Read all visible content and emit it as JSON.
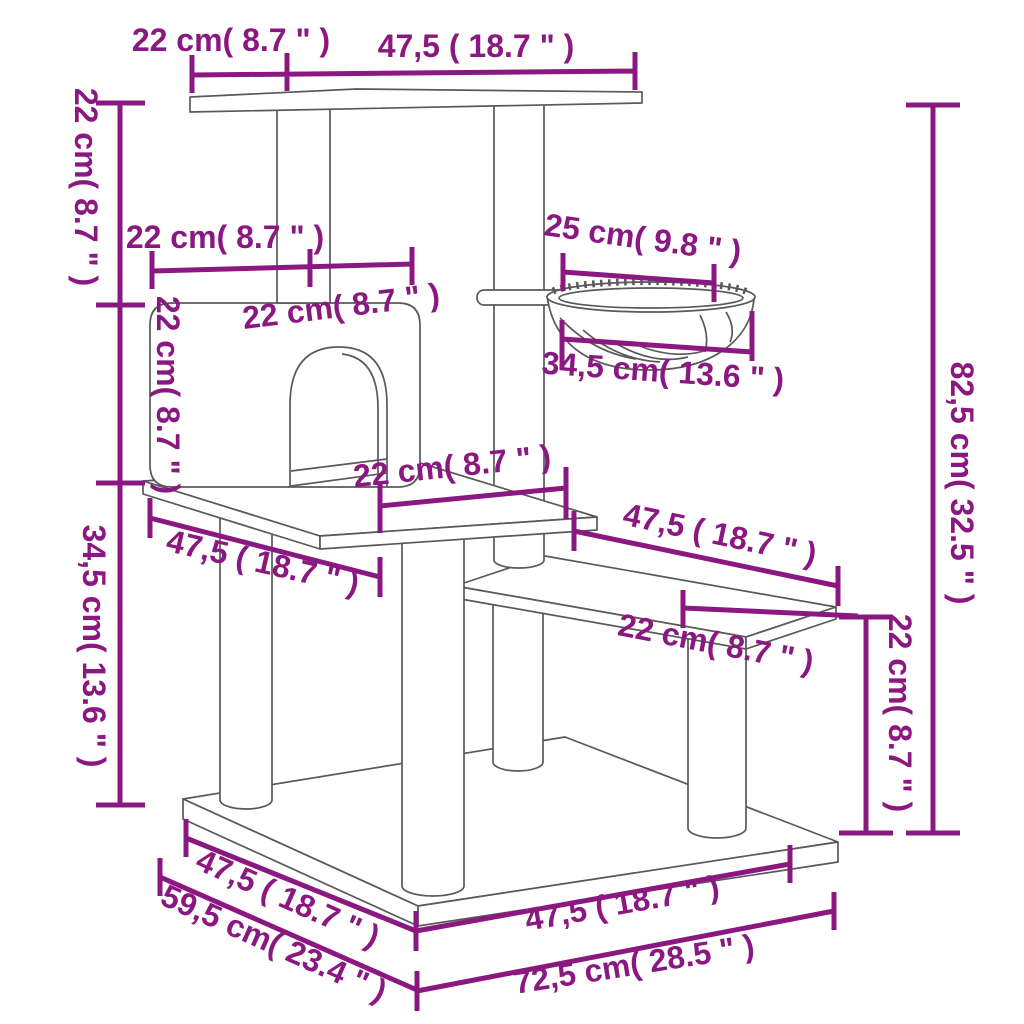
{
  "diagram": {
    "kind": "product-dimension-diagram",
    "subject": "cat tree with scratching posts, condo house, hammock basket, step platform and base",
    "unit_style": "centimeters with inches in parentheses"
  },
  "colors": {
    "dimension_accent": "#8b1880",
    "line_art": "#595959",
    "background": "#ffffff"
  },
  "dimensions": {
    "top_offset": "22 cm( 8.7 \" )",
    "top_platform_length": "47,5 ( 18.7 \" )",
    "upper_section_height": "22 cm( 8.7 \" )",
    "house_width": "22 cm( 8.7 \" )",
    "house_post_spacing": "22 cm( 8.7 \" )",
    "house_height": "22 cm( 8.7 \" )",
    "hammock_opening": "25 cm( 9.8 \" )",
    "hammock_width": "34,5 cm( 13.6 \" )",
    "mid_platform_depth": "22 cm( 8.7 \" )",
    "mid_platform_length": "47,5 ( 18.7 \" )",
    "step_platform_length": "47,5 ( 18.7 \" )",
    "step_platform_depth": "22 cm( 8.7 \" )",
    "total_height": "82,5 cm( 32.5 \" )",
    "step_height": "22 cm( 8.7 \" )",
    "lower_section_height": "34,5 cm( 13.6 \" )",
    "base_length_left": "47,5 ( 18.7 \" )",
    "base_depth_left": "59,5 cm( 23.4 \" )",
    "base_length_right": "47,5 ( 18.7 \" )",
    "base_width_right": "72,5 cm( 28.5 \" )"
  }
}
